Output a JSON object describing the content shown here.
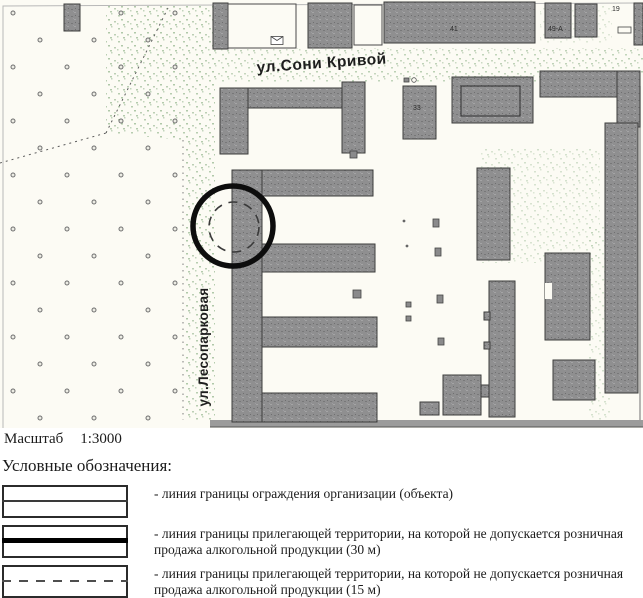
{
  "map": {
    "streets": {
      "horizontal": "ул.Сони Кривой",
      "vertical": "ул.Лесопарковая"
    },
    "building_numbers": [
      "41",
      "49-А",
      "19",
      "33"
    ],
    "marker": {
      "shape": "circle-annotation-with-inner-dashed-circle"
    },
    "colors": {
      "building_fill": "#8f8f90",
      "building_outline": "#3d3d3d",
      "paper": "#fcfbf4",
      "street_speckle": "#b7cdb0",
      "marker": "#0d0d0d"
    }
  },
  "scale": {
    "label": "Масштаб",
    "value": "1:3000"
  },
  "legend": {
    "title": "Условные обозначения:",
    "items": [
      {
        "line_style": "thin-solid",
        "text": "- линия границы ограждения организации (объекта)"
      },
      {
        "line_style": "thick-solid",
        "text": "- линия границы прилегающей территории, на которой не допускается розничная продажа алкогольной продукции (30 м)"
      },
      {
        "line_style": "dashed",
        "text": "- линия границы прилегающей территории, на которой не допускается розничная продажа алкогольной продукции (15 м)"
      }
    ]
  }
}
